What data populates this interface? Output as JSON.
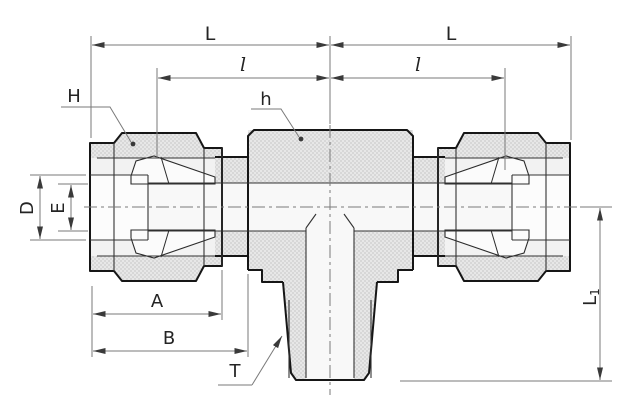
{
  "figure": {
    "kind": "engineering-dimension-drawing",
    "subject": "branch tee compression tube fitting, side view with dimension callouts"
  },
  "labels": {
    "L_left": "L",
    "L_right": "L",
    "l_left": "l",
    "l_right": "l",
    "H": "H",
    "h": "h",
    "D": "D",
    "E": "E",
    "A": "A",
    "B": "B",
    "T": "T",
    "L1_main": "L",
    "L1_sub": "1"
  },
  "colors": {
    "background": "#ffffff",
    "outline": "#161616",
    "inner_line": "#333333",
    "dimension_line": "#7a7a7a",
    "arrow": "#3a3a3a",
    "metal_fill_light": "#e7e7e7",
    "metal_fill_dark": "#d7d7d7",
    "cavity_fill": "#f2f2f2",
    "bore_fill": "#f8f8f8"
  }
}
